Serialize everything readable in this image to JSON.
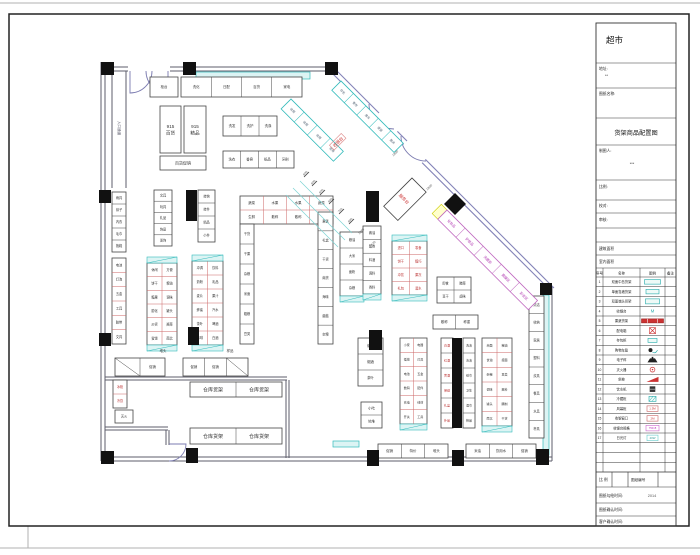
{
  "sheet": {
    "title": "超市",
    "fields": {
      "addr_label": "地址:",
      "addr_value": "**",
      "name_label": "图纸名称:",
      "drawing_title": "货架商品配置图",
      "maker_label": "制图人:",
      "maker_value": "***",
      "scale_label": "比例:",
      "check_label": "校对:",
      "audit_label": "审核:",
      "area1_label": "建筑面积",
      "area2_label": "室内面积"
    },
    "footer": {
      "scale": "比 例",
      "sheet_no": "图纸编号",
      "draw_time_label": "图纸勾绘时间:",
      "draw_time_value": "2014",
      "confirm_time_label": "图纸确认时间:",
      "client_time_label": "客户确认时间:"
    },
    "legend": {
      "headers": [
        "序号",
        "名称",
        "图例",
        "备注"
      ],
      "rows": [
        {
          "no": "1",
          "name": "双面中岛货架",
          "sym": "tealbox",
          "symtext": ""
        },
        {
          "no": "2",
          "name": "单面靠墙货架",
          "sym": "tealbox2",
          "symtext": ""
        },
        {
          "no": "3",
          "name": "双面端头货架",
          "sym": "tealbox3",
          "symtext": ""
        },
        {
          "no": "4",
          "name": "收银台",
          "sym": "tealM",
          "symtext": "M"
        },
        {
          "no": "5",
          "name": "果蔬货架",
          "sym": "redbar",
          "symtext": ""
        },
        {
          "no": "6",
          "name": "配电箱",
          "sym": "redx",
          "symtext": ""
        },
        {
          "no": "7",
          "name": "存包柜",
          "sym": "tealsm",
          "symtext": ""
        },
        {
          "no": "8",
          "name": "购物车篮",
          "sym": "cart",
          "symtext": ""
        },
        {
          "no": "9",
          "name": "电子秤",
          "sym": "scale",
          "symtext": ""
        },
        {
          "no": "10",
          "name": "灭火器",
          "sym": "redring",
          "symtext": ""
        },
        {
          "no": "11",
          "name": "斜坡",
          "sym": "ramp",
          "symtext": ""
        },
        {
          "no": "12",
          "name": "饮水机",
          "sym": "blackbox",
          "symtext": ""
        },
        {
          "no": "13",
          "name": "冷藏柜",
          "sym": "tealhatch",
          "symtext": ""
        },
        {
          "no": "14",
          "name": "风幕柜",
          "sym": "redtext",
          "symtext": "1.5M"
        },
        {
          "no": "15",
          "name": "收银窗口",
          "sym": "redtext",
          "symtext": "2M"
        },
        {
          "no": "16",
          "name": "收银台规格",
          "sym": "magtext",
          "symtext": "750×8"
        },
        {
          "no": "17",
          "name": "日光灯",
          "sym": "cyantext",
          "symtext": "40W"
        },
        {
          "no": "",
          "name": "",
          "sym": "",
          "symtext": ""
        },
        {
          "no": "",
          "name": "",
          "sym": "",
          "symtext": ""
        },
        {
          "no": "",
          "name": "",
          "sym": "",
          "symtext": ""
        }
      ]
    }
  },
  "plan": {
    "bands": [
      {
        "x": 196,
        "y": 72,
        "w": 114,
        "h": 7
      },
      {
        "x": 543,
        "y": 295,
        "w": 6,
        "h": 160
      },
      {
        "x": 333,
        "y": 441,
        "w": 26,
        "h": 6
      }
    ],
    "shelves": [
      {
        "x": 150,
        "y": 77,
        "w": 28,
        "h": 20,
        "c": 1,
        "r": 1,
        "L": [
          "柜台"
        ]
      },
      {
        "x": 181,
        "y": 77,
        "w": 121,
        "h": 20,
        "c": 4,
        "r": 1,
        "L": [
          "洗化",
          "日配",
          "百货",
          "家电"
        ]
      },
      {
        "x": 160,
        "y": 106,
        "w": 21,
        "h": 47,
        "nl": 1,
        "L": [
          "915",
          "百货"
        ],
        "fs": 4.6
      },
      {
        "x": 184,
        "y": 106,
        "w": 22,
        "h": 47,
        "nl": 1,
        "L": [
          "915",
          "精品"
        ],
        "fs": 4.6
      },
      {
        "x": 160,
        "y": 156,
        "w": 46,
        "h": 14,
        "c": 1,
        "r": 1,
        "L": [
          "百货促销"
        ],
        "fs": 4
      },
      {
        "x": 223,
        "y": 116,
        "w": 54,
        "h": 20,
        "c": 3,
        "r": 1,
        "L": [
          "洗发",
          "洗护",
          "洗涤"
        ]
      },
      {
        "x": 223,
        "y": 151,
        "w": 71,
        "h": 17,
        "c": 4,
        "r": 1,
        "L": [
          "洗衣",
          "香皂",
          "纸品",
          "牙刷"
        ]
      },
      {
        "x": 112,
        "y": 192,
        "w": 14,
        "h": 60,
        "c": 1,
        "r": 5,
        "L": [
          "雨具",
          "袜子",
          "内衣",
          "毛巾",
          "拖鞋"
        ],
        "fs": 3.2
      },
      {
        "x": 112,
        "y": 258,
        "w": 14,
        "h": 86,
        "c": 1,
        "r": 6,
        "in": "#c66",
        "L": [
          "电池",
          "灯泡",
          "五金",
          "工具",
          "胶带",
          "文具"
        ],
        "fs": 3.2
      },
      {
        "x": 154,
        "y": 190,
        "w": 18,
        "h": 56,
        "c": 1,
        "r": 5,
        "L": [
          "文具",
          "玩具",
          "礼品",
          "饰品",
          "发饰"
        ],
        "fs": 3.2
      },
      {
        "x": 198,
        "y": 190,
        "w": 17,
        "h": 52,
        "c": 1,
        "r": 4,
        "L": [
          "挂钩",
          "挂件",
          "精品",
          "小件"
        ],
        "fs": 3.2
      },
      {
        "x": 147,
        "y": 263,
        "w": 30,
        "h": 82,
        "c": 2,
        "r": 6,
        "cap": "tb",
        "in": "#c66",
        "L": [
          "休闲",
          "方便",
          "饼干",
          "粮油",
          "糖果",
          "调味",
          "膨化",
          "罐头",
          "炒货",
          "酱菜",
          "蜜饯",
          "南北"
        ],
        "fs": 3.2
      },
      {
        "x": 192,
        "y": 261,
        "w": 31,
        "h": 84,
        "c": 2,
        "r": 6,
        "cap": "tb",
        "in": "#c66",
        "L": [
          "冲调",
          "饮料",
          "奶粉",
          "乳品",
          "麦片",
          "果汁",
          "蜂蜜",
          "汽水",
          "茶叶",
          "啤酒",
          "咖啡",
          "白酒"
        ],
        "fs": 3.2
      },
      {
        "x": 240,
        "y": 196,
        "w": 93,
        "h": 28,
        "c": 4,
        "r": 2,
        "in": "#c66",
        "L": [
          "蔬菜",
          "水果",
          "水果",
          "蔬菜",
          "生鲜",
          "散称",
          "散称",
          "生鲜"
        ],
        "fs": 3.4
      },
      {
        "x": 240,
        "y": 224,
        "w": 14,
        "h": 120,
        "c": 1,
        "r": 6,
        "L": [
          "干货",
          "干果",
          "杂粮",
          "米面",
          "粗粮",
          "豆类"
        ],
        "fs": 3.2
      },
      {
        "x": 318,
        "y": 212,
        "w": 15,
        "h": 132,
        "c": 1,
        "r": 7,
        "L": [
          "果篮",
          "礼盒",
          "干货",
          "南货",
          "海味",
          "菌菇",
          "杂粮"
        ],
        "fs": 3.2
      },
      {
        "x": 340,
        "y": 232,
        "w": 24,
        "h": 64,
        "c": 1,
        "r": 4,
        "cap": "b",
        "L": [
          "粮油",
          "大米",
          "面粉",
          "杂粮"
        ],
        "fs": 3.2
      },
      {
        "x": 363,
        "y": 226,
        "w": 18,
        "h": 68,
        "c": 1,
        "r": 5,
        "cap": "b",
        "L": [
          "酱油",
          "醋类",
          "料酒",
          "调料",
          "香料"
        ],
        "fs": 3.2
      },
      {
        "x": 392,
        "y": 241,
        "w": 35,
        "h": 54,
        "c": 2,
        "r": 4,
        "cap": "tb",
        "in": "#c66",
        "tc": "#b33",
        "L": [
          "进口",
          "零食",
          "饼干",
          "糖巧",
          "冲饮",
          "果冻",
          "礼包",
          "酒水"
        ],
        "fs": 3.2
      },
      {
        "x": 437,
        "y": 277,
        "w": 34,
        "h": 26,
        "c": 2,
        "r": 2,
        "L": [
          "即食",
          "腌菜",
          "豆干",
          "卤味"
        ],
        "fs": 3.2
      },
      {
        "x": 433,
        "y": 315,
        "w": 45,
        "h": 14,
        "c": 2,
        "r": 1,
        "L": [
          "散称",
          "称重"
        ],
        "fs": 3.4
      },
      {
        "x": 529,
        "y": 296,
        "w": 15,
        "h": 142,
        "c": 1,
        "r": 8,
        "L": [
          "清洁",
          "收纳",
          "家居",
          "塑料",
          "炊具",
          "餐具",
          "水具",
          "杯具"
        ],
        "fs": 3.2
      },
      {
        "x": 441,
        "y": 338,
        "w": 12,
        "h": 90,
        "c": 1,
        "r": 6,
        "tc": "#b33",
        "L": [
          "白酒",
          "红酒",
          "黄酒",
          "保健",
          "礼盒",
          "补品"
        ],
        "fs": 3
      },
      {
        "x": 463,
        "y": 338,
        "w": 12,
        "h": 90,
        "c": 1,
        "r": 6,
        "L": [
          "洗洁",
          "清洁",
          "纸巾",
          "卫生",
          "湿巾",
          "棉品"
        ],
        "fs": 3
      },
      {
        "x": 400,
        "y": 338,
        "w": 27,
        "h": 86,
        "c": 2,
        "r": 6,
        "cap": "b",
        "in": "#c66",
        "L": [
          "小家",
          "电器",
          "插排",
          "灯具",
          "电池",
          "五金",
          "数码",
          "配件",
          "充电",
          "线材",
          "开关",
          "工具"
        ],
        "fs": 3
      },
      {
        "x": 358,
        "y": 338,
        "w": 25,
        "h": 48,
        "c": 1,
        "r": 3,
        "L": [
          "烟酒",
          "烟酒",
          "茶叶"
        ],
        "fs": 3.4
      },
      {
        "x": 361,
        "y": 402,
        "w": 21,
        "h": 26,
        "c": 1,
        "r": 2,
        "L": [
          "小吃",
          "地堆"
        ],
        "fs": 3.4
      },
      {
        "x": 482,
        "y": 338,
        "w": 30,
        "h": 88,
        "c": 2,
        "r": 6,
        "cap": "b",
        "in": "#c66",
        "L": [
          "米面",
          "粮油",
          "食油",
          "挂面",
          "杂粮",
          "豆类",
          "调味",
          "酱料",
          "罐头",
          "腌制",
          "南北",
          "干货"
        ],
        "fs": 3
      },
      {
        "x": 378,
        "y": 444,
        "w": 70,
        "h": 14,
        "c": 3,
        "r": 1,
        "L": [
          "促销",
          "特价",
          "堆头"
        ],
        "fs": 3.4
      },
      {
        "x": 466,
        "y": 444,
        "w": 70,
        "h": 14,
        "c": 3,
        "r": 1,
        "L": [
          "米油",
          "饮用水",
          "促销"
        ],
        "fs": 3.4
      },
      {
        "x": 115,
        "y": 358,
        "w": 50,
        "h": 18,
        "c": 2,
        "r": 1,
        "hatch": [
          0
        ],
        "L": [
          "",
          "促销"
        ],
        "fs": 3.4
      },
      {
        "x": 183,
        "y": 358,
        "w": 65,
        "h": 18,
        "c": 3,
        "r": 1,
        "hatch": [
          2
        ],
        "L": [
          "促销",
          "促销",
          ""
        ],
        "fs": 3.4
      },
      {
        "x": 113,
        "y": 380,
        "w": 14,
        "h": 28,
        "c": 1,
        "r": 2,
        "tc": "#b33",
        "in": "#c66",
        "L": [
          "冰柜",
          "冷饮"
        ],
        "fs": 3.2
      },
      {
        "x": 115,
        "y": 410,
        "w": 18,
        "h": 13,
        "c": 1,
        "r": 1,
        "L": [
          "灭火"
        ],
        "fs": 3.2
      },
      {
        "x": 190,
        "y": 382,
        "w": 92,
        "h": 15,
        "c": 2,
        "r": 1,
        "L": [
          "仓库货架",
          "仓库货架"
        ],
        "fs": 5
      },
      {
        "x": 190,
        "y": 428,
        "w": 92,
        "h": 16,
        "c": 2,
        "r": 1,
        "L": [
          "仓库货架",
          "仓库货架"
        ],
        "fs": 5
      },
      {
        "x": 291,
        "y": 99,
        "w": 74,
        "h": 14,
        "c": 4,
        "r": 1,
        "rot": [
          45,
          291,
          99
        ],
        "sc": "#3bb",
        "tc": "#567",
        "L": [
          "收银",
          "收银",
          "收银",
          "收银"
        ],
        "fs": 3
      },
      {
        "x": 341,
        "y": 81,
        "w": 88,
        "h": 13,
        "c": 5,
        "r": 1,
        "rot": [
          45,
          341,
          81
        ],
        "sc": "#3bb",
        "tc": "#567",
        "L": [
          "存包",
          "寄存",
          "推车",
          "提篮",
          "服务"
        ],
        "fs": 3
      },
      {
        "x": 447,
        "y": 210,
        "w": 128,
        "h": 13,
        "c": 5,
        "r": 1,
        "rot": [
          45,
          447,
          210
        ],
        "sc": "#c06ac0",
        "tc": "#b23ab2",
        "capc": "#ffffcc",
        "L": [
          "化妆品",
          "护肤品",
          "洗面奶",
          "面膜区",
          "彩妆区"
        ],
        "fs": 3.4
      },
      {
        "x": 412,
        "y": 178,
        "w": 20,
        "h": 40,
        "c": 1,
        "r": 1,
        "rot": [
          45,
          412,
          178
        ],
        "L": [
          ""
        ]
      }
    ],
    "columns": [
      [
        101,
        62,
        13,
        13
      ],
      [
        183,
        62,
        13,
        13
      ],
      [
        325,
        62,
        13,
        13
      ],
      [
        99,
        190,
        12,
        13
      ],
      [
        99,
        333,
        12,
        13
      ],
      [
        101,
        451,
        13,
        13
      ],
      [
        186,
        448,
        12,
        15
      ],
      [
        367,
        450,
        12,
        16
      ],
      [
        452,
        450,
        12,
        16
      ],
      [
        536,
        449,
        13,
        16
      ],
      [
        540,
        283,
        12,
        12
      ],
      [
        186,
        190,
        11,
        31
      ],
      [
        366,
        191,
        13,
        31
      ],
      [
        452,
        338,
        10,
        90
      ],
      [
        369,
        330,
        13,
        20
      ],
      [
        188,
        327,
        11,
        18
      ]
    ],
    "diamond": "455,193 466,204 455,215 444,204",
    "texts": [
      {
        "t": "收银台",
        "x": 338,
        "y": 142,
        "rot": -45,
        "c": "#c33",
        "fs": 4.2,
        "box": "#d88"
      },
      {
        "t": "服务台",
        "x": 404,
        "y": 199,
        "rot": 45,
        "c": "#c33",
        "fs": 4.2
      },
      {
        "t": "入口通道",
        "x": 119,
        "y": 128,
        "rot": 90,
        "c": "#556",
        "fs": 3.6
      },
      {
        "t": "堆头",
        "x": 163,
        "y": 351,
        "c": "#333",
        "fs": 3.4
      },
      {
        "t": "样品",
        "x": 230,
        "y": 351,
        "c": "#333",
        "fs": 3.4
      }
    ],
    "dims": [
      [
        "600",
        306,
        174
      ],
      [
        "600",
        314,
        183
      ],
      [
        "600",
        322,
        192
      ],
      [
        "680",
        331,
        201
      ],
      [
        "760",
        341,
        211
      ],
      [
        "890",
        351,
        221
      ],
      [
        "1380",
        362,
        232
      ],
      [
        "130",
        374,
        244
      ],
      [
        "1800",
        396,
        154
      ],
      [
        "1800",
        430,
        188
      ]
    ],
    "lines": [
      [
        300,
        181,
        352,
        233,
        "#7fd4d4"
      ],
      [
        293,
        188,
        345,
        240,
        "#7fd4d4"
      ],
      [
        286,
        195,
        338,
        247,
        "#7fd4d4"
      ],
      [
        304,
        177,
        309,
        172,
        "#333"
      ],
      [
        312,
        186,
        317,
        181,
        "#333"
      ],
      [
        320,
        195,
        325,
        190,
        "#333"
      ],
      [
        329,
        204,
        334,
        199,
        "#333"
      ],
      [
        339,
        214,
        344,
        209,
        "#333"
      ],
      [
        349,
        224,
        354,
        219,
        "#333"
      ]
    ]
  }
}
